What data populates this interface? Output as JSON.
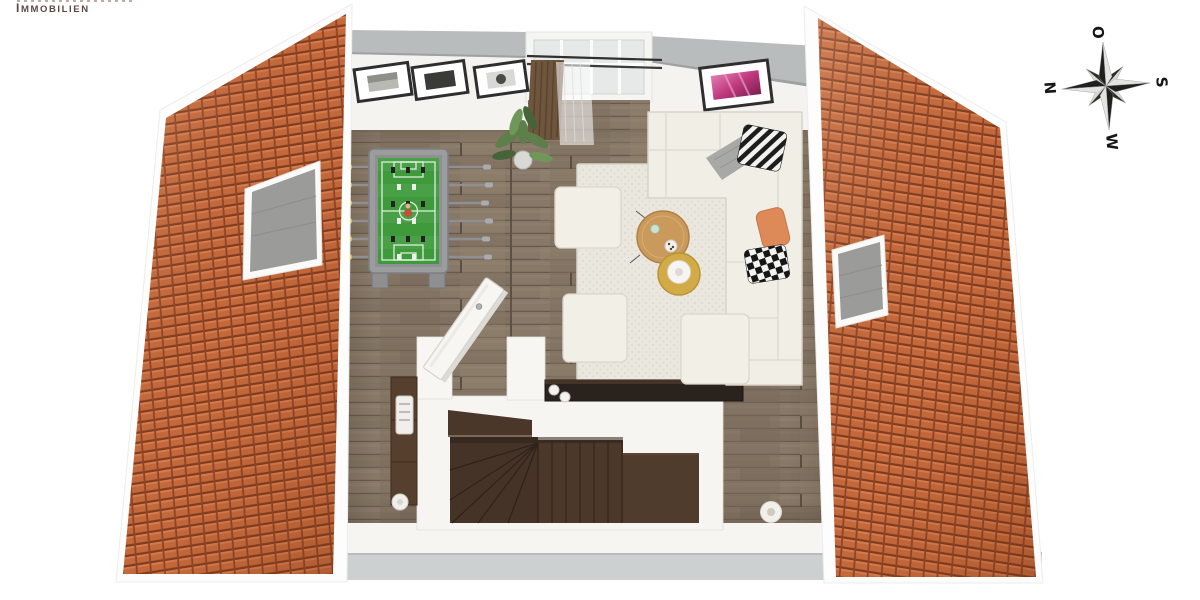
{
  "branding": {
    "logo_text": "IMMOBILIEN"
  },
  "compass": {
    "north_label": "N",
    "east_label": "O",
    "south_label": "S",
    "west_label": "W"
  },
  "palette": {
    "roof_tile": "#c4693c",
    "roof_tile_gap": "#7f3c1f",
    "wood_floor": "#877868",
    "stair_wood": "#4b382a",
    "wall_white": "#f6f5f2",
    "wall_top_gray": "#b9bcbd",
    "base_gray_band": "#cdd0d1",
    "rug": "#eae7df",
    "sofa": "#f1eee6",
    "foosball_field": "#3e9a3b",
    "foosball_frame": "#9b9c9e",
    "foosball_handle_yellow": "#e3c234",
    "accent_pillow_orange": "#dd8a58",
    "coffee_table_wood": "#c99a5c",
    "side_table_yellow": "#d2ab46",
    "curtain_brown": "#6e553c",
    "picture_pink": "#c0397e",
    "skylight_glass": "#9b9b99"
  }
}
